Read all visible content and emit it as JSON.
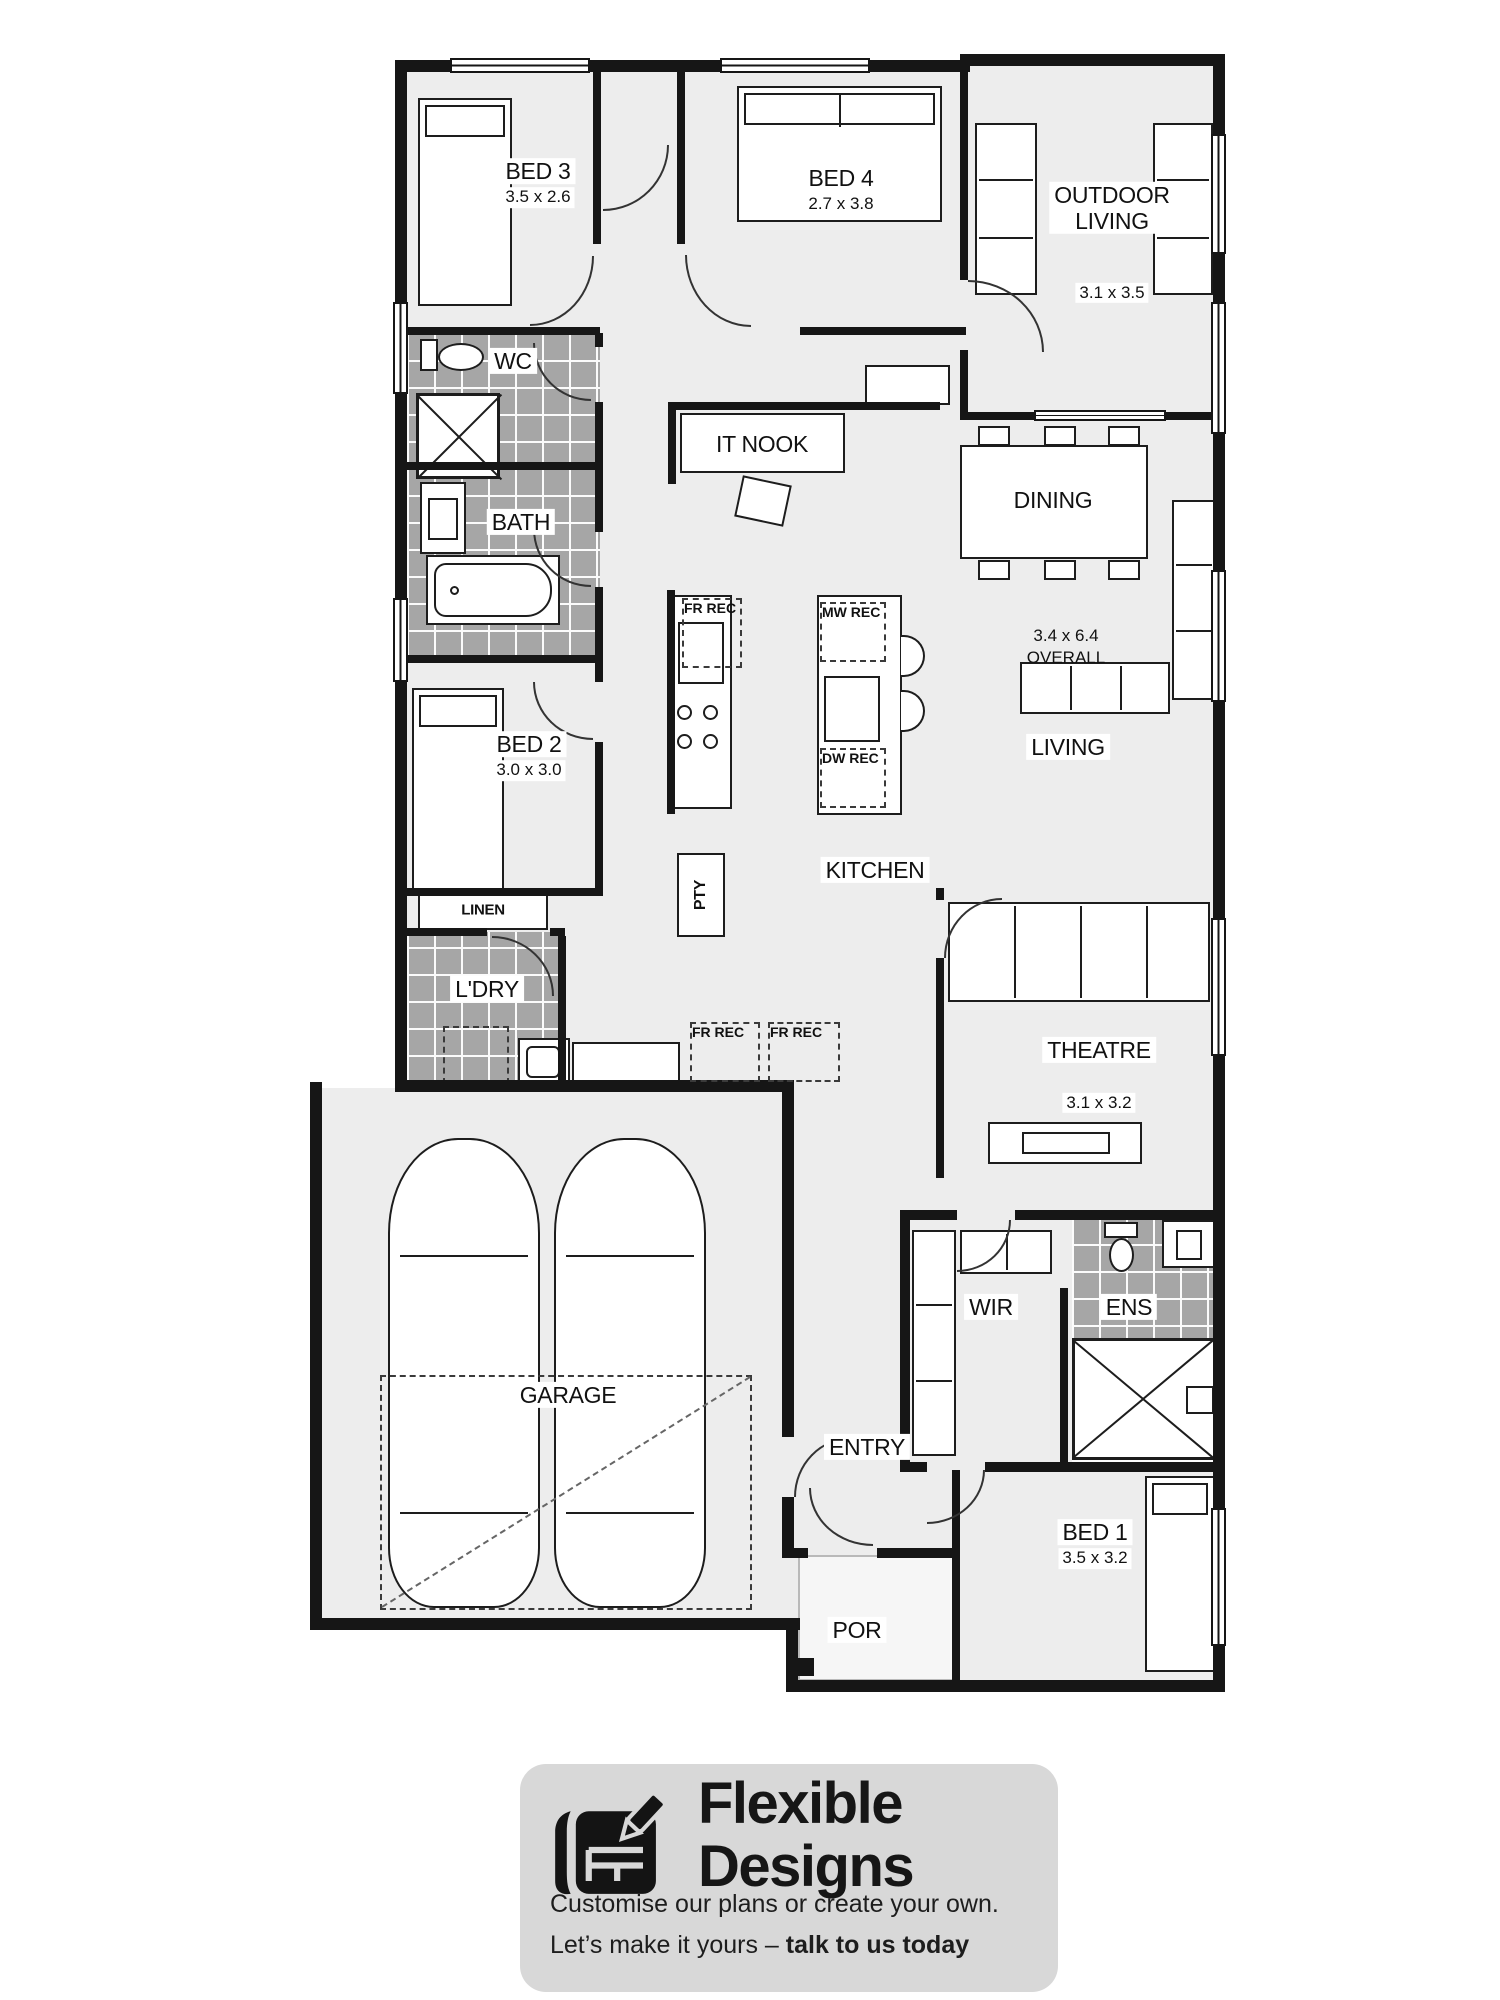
{
  "plan": {
    "rooms": {
      "bed3": {
        "name": "BED 3",
        "dim": "3.5 x 2.6"
      },
      "bed4": {
        "name": "BED 4",
        "dim": "2.7 x 3.8"
      },
      "outdoor_living": {
        "name": "OUTDOOR\nLIVING",
        "dim": "3.1 x 3.5"
      },
      "wc": {
        "name": "WC"
      },
      "bath": {
        "name": "BATH"
      },
      "it_nook": {
        "name": "IT NOOK"
      },
      "dining": {
        "name": "DINING"
      },
      "living": {
        "name": "LIVING",
        "overall": "3.4 x 6.4\nOVERALL"
      },
      "bed2": {
        "name": "BED 2",
        "dim": "3.0 x 3.0"
      },
      "kitchen": {
        "name": "KITCHEN"
      },
      "pantry": {
        "name": "PTY"
      },
      "linen": {
        "name": "LINEN"
      },
      "laundry": {
        "name": "L'DRY"
      },
      "theatre": {
        "name": "THEATRE",
        "dim": "3.1 x 3.2"
      },
      "wir": {
        "name": "WIR"
      },
      "ens": {
        "name": "ENS"
      },
      "garage": {
        "name": "GARAGE"
      },
      "entry": {
        "name": "ENTRY"
      },
      "bed1": {
        "name": "BED 1",
        "dim": "3.5 x 3.2"
      },
      "porch": {
        "name": "POR"
      }
    },
    "recs": {
      "fr1": "FR REC",
      "fr2": "FR REC",
      "fr3": "FR REC",
      "mw": "MW REC",
      "dw": "DW REC"
    }
  },
  "brand": {
    "name_line1": "Flexible",
    "name_line2": "Designs",
    "tagline_line1": "Customise our plans or create your own.",
    "tagline_line2_prefix": "Let’s make it yours – ",
    "tagline_line2_bold": "talk to us today"
  },
  "colors": {
    "wall": "#161616",
    "floor": "#ededed",
    "tile": "#a6a6a6",
    "banner_bg": "#d8d8d8",
    "ink": "#111111"
  }
}
